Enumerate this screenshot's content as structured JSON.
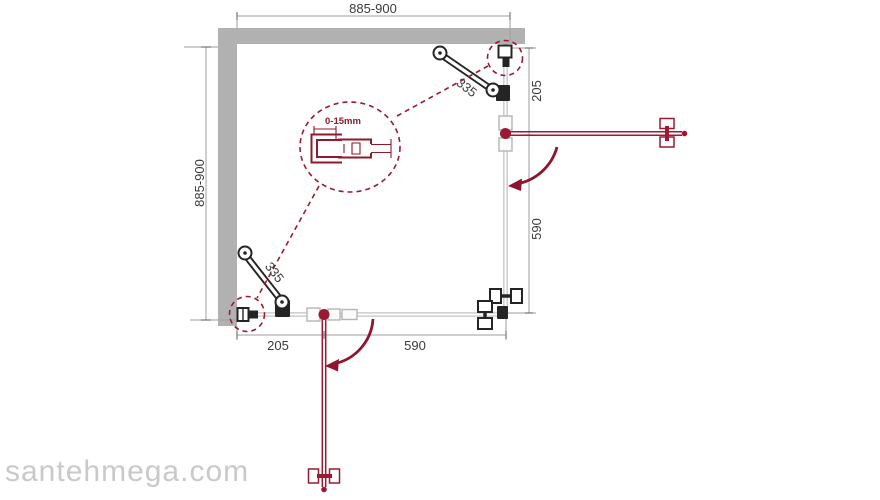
{
  "diagram": {
    "title_hint": "shower-enclosure-plan-drawing",
    "dimensions": {
      "top_width": "885-900",
      "left_depth": "885-900",
      "right_fixed": "205",
      "right_door": "590",
      "bottom_fixed": "205",
      "bottom_door": "590",
      "brace_top": "335",
      "brace_bottom": "335",
      "detail_adjustment": "0-15mm"
    },
    "watermark": "santehmega.com",
    "colors": {
      "red": "#9A1A33",
      "arc_red": "#8F1430",
      "wall_gray": "#B1B1B1",
      "glass_gray": "#C3C3C3",
      "hardware_black": "#242424",
      "dim_gray": "#9E9E9E",
      "text": "#3B3B3B",
      "watermark_gray": "#C9C9C9",
      "detail_red": "#8E1A2C"
    }
  }
}
